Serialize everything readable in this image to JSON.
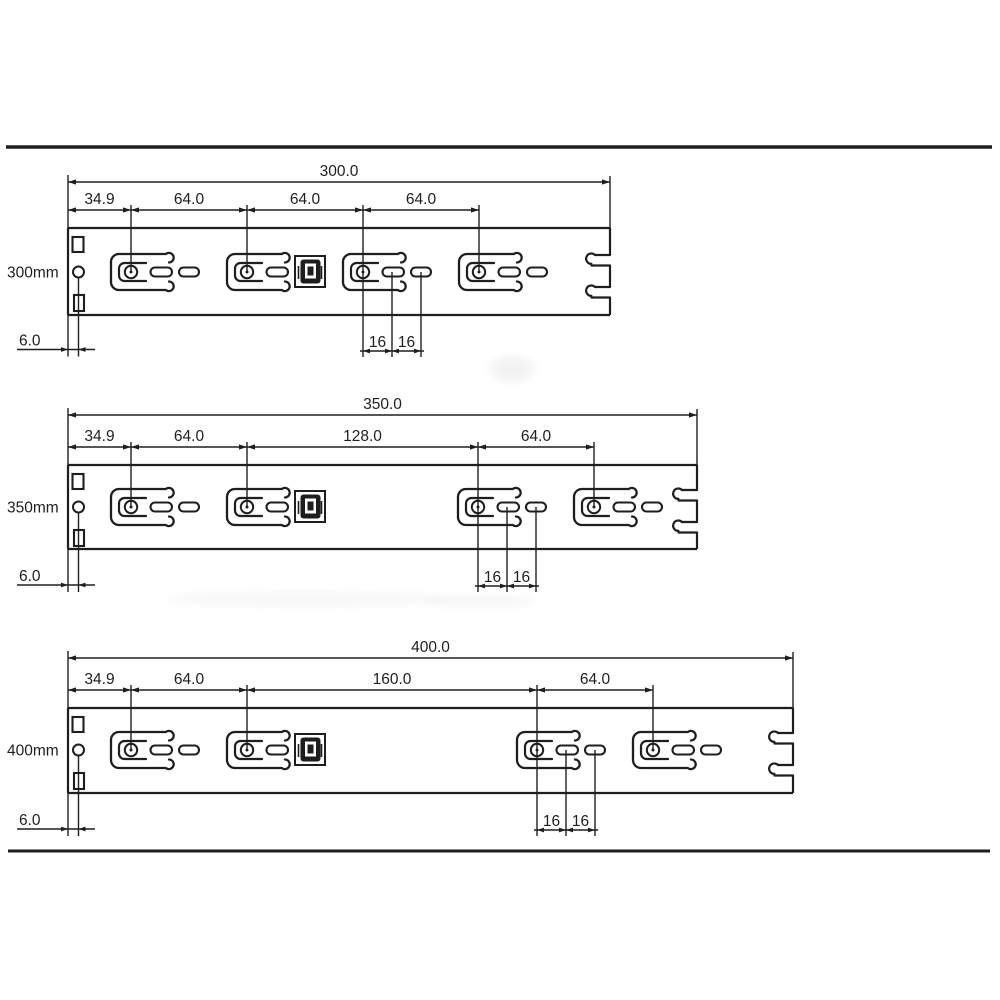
{
  "diagram": {
    "type": "technical_drawing",
    "units": "mm",
    "colors": {
      "background": "#ffffff",
      "line": "#1e1e1e",
      "text": "#1e1e1e"
    },
    "border_lines": [
      {
        "y": 147,
        "x1": 6,
        "x2": 992,
        "w": 3.5
      },
      {
        "y": 851,
        "x1": 8,
        "x2": 990,
        "w": 3
      }
    ],
    "rails": [
      {
        "name_label": "300mm",
        "total_label": "300.0",
        "segment_labels": [
          "34.9",
          "64.0",
          "64.0",
          "64.0"
        ],
        "hole_spacing_labels": [
          "16",
          "16"
        ],
        "offset_label": "6.0",
        "values_mm": {
          "length": 300.0,
          "front_lead": 34.9,
          "pitches": [
            64.0,
            64.0,
            64.0
          ],
          "hole_spacing": [
            16,
            16
          ],
          "edge_offset": 6.0
        },
        "geo": {
          "band_top": 228,
          "band_bottom": 315,
          "mid": 272,
          "left": 68,
          "right": 610,
          "total_dim_y": 182,
          "seg_dim_y": 210,
          "seg_xs": [
            68,
            131,
            247,
            363,
            479
          ],
          "keyholes": [
            131,
            247,
            363,
            479
          ],
          "iso_pills": [
            189,
            421,
            537
          ],
          "latch_x": 295,
          "notch_ys": [
            255,
            287
          ],
          "spacing_xs": [
            363,
            392,
            421
          ],
          "spacing_dim_y": 351,
          "offset_dim_y": 349.5
        }
      },
      {
        "name_label": "350mm",
        "total_label": "350.0",
        "segment_labels": [
          "34.9",
          "64.0",
          "128.0",
          "64.0"
        ],
        "hole_spacing_labels": [
          "16",
          "16"
        ],
        "offset_label": "6.0",
        "values_mm": {
          "length": 350.0,
          "front_lead": 34.9,
          "pitches": [
            64.0,
            128.0,
            64.0
          ],
          "hole_spacing": [
            16,
            16
          ],
          "edge_offset": 6.0
        },
        "geo": {
          "band_top": 465,
          "band_bottom": 549,
          "mid": 507,
          "left": 68,
          "right": 697,
          "total_dim_y": 415,
          "seg_dim_y": 447,
          "seg_xs": [
            68,
            131,
            247,
            478,
            594
          ],
          "keyholes": [
            131,
            247,
            478,
            594
          ],
          "iso_pills": [
            189,
            536,
            652
          ],
          "latch_x": 295,
          "notch_ys": [
            490,
            522
          ],
          "spacing_xs": [
            478,
            507,
            536
          ],
          "spacing_dim_y": 586,
          "offset_dim_y": 585
        }
      },
      {
        "name_label": "400mm",
        "total_label": "400.0",
        "segment_labels": [
          "34.9",
          "64.0",
          "160.0",
          "64.0"
        ],
        "hole_spacing_labels": [
          "16",
          "16"
        ],
        "offset_label": "6.0",
        "values_mm": {
          "length": 400.0,
          "front_lead": 34.9,
          "pitches": [
            64.0,
            160.0,
            64.0
          ],
          "hole_spacing": [
            16,
            16
          ],
          "edge_offset": 6.0
        },
        "geo": {
          "band_top": 708,
          "band_bottom": 793,
          "mid": 750,
          "left": 68,
          "right": 793,
          "total_dim_y": 658,
          "seg_dim_y": 690,
          "seg_xs": [
            68,
            131,
            247,
            537,
            653
          ],
          "keyholes": [
            131,
            247,
            537,
            653
          ],
          "iso_pills": [
            189,
            595,
            711
          ],
          "latch_x": 295,
          "notch_ys": [
            733,
            765
          ],
          "spacing_xs": [
            537,
            566,
            595
          ],
          "spacing_dim_y": 830,
          "offset_dim_y": 829
        }
      }
    ],
    "artifacts": [
      {
        "x": 512,
        "y": 369,
        "rx": 22,
        "ry": 13,
        "opacity": 0.1
      },
      {
        "x": 305,
        "y": 599,
        "rx": 140,
        "ry": 8,
        "opacity": 0.06
      },
      {
        "x": 480,
        "y": 601,
        "rx": 55,
        "ry": 7,
        "opacity": 0.06
      }
    ]
  }
}
